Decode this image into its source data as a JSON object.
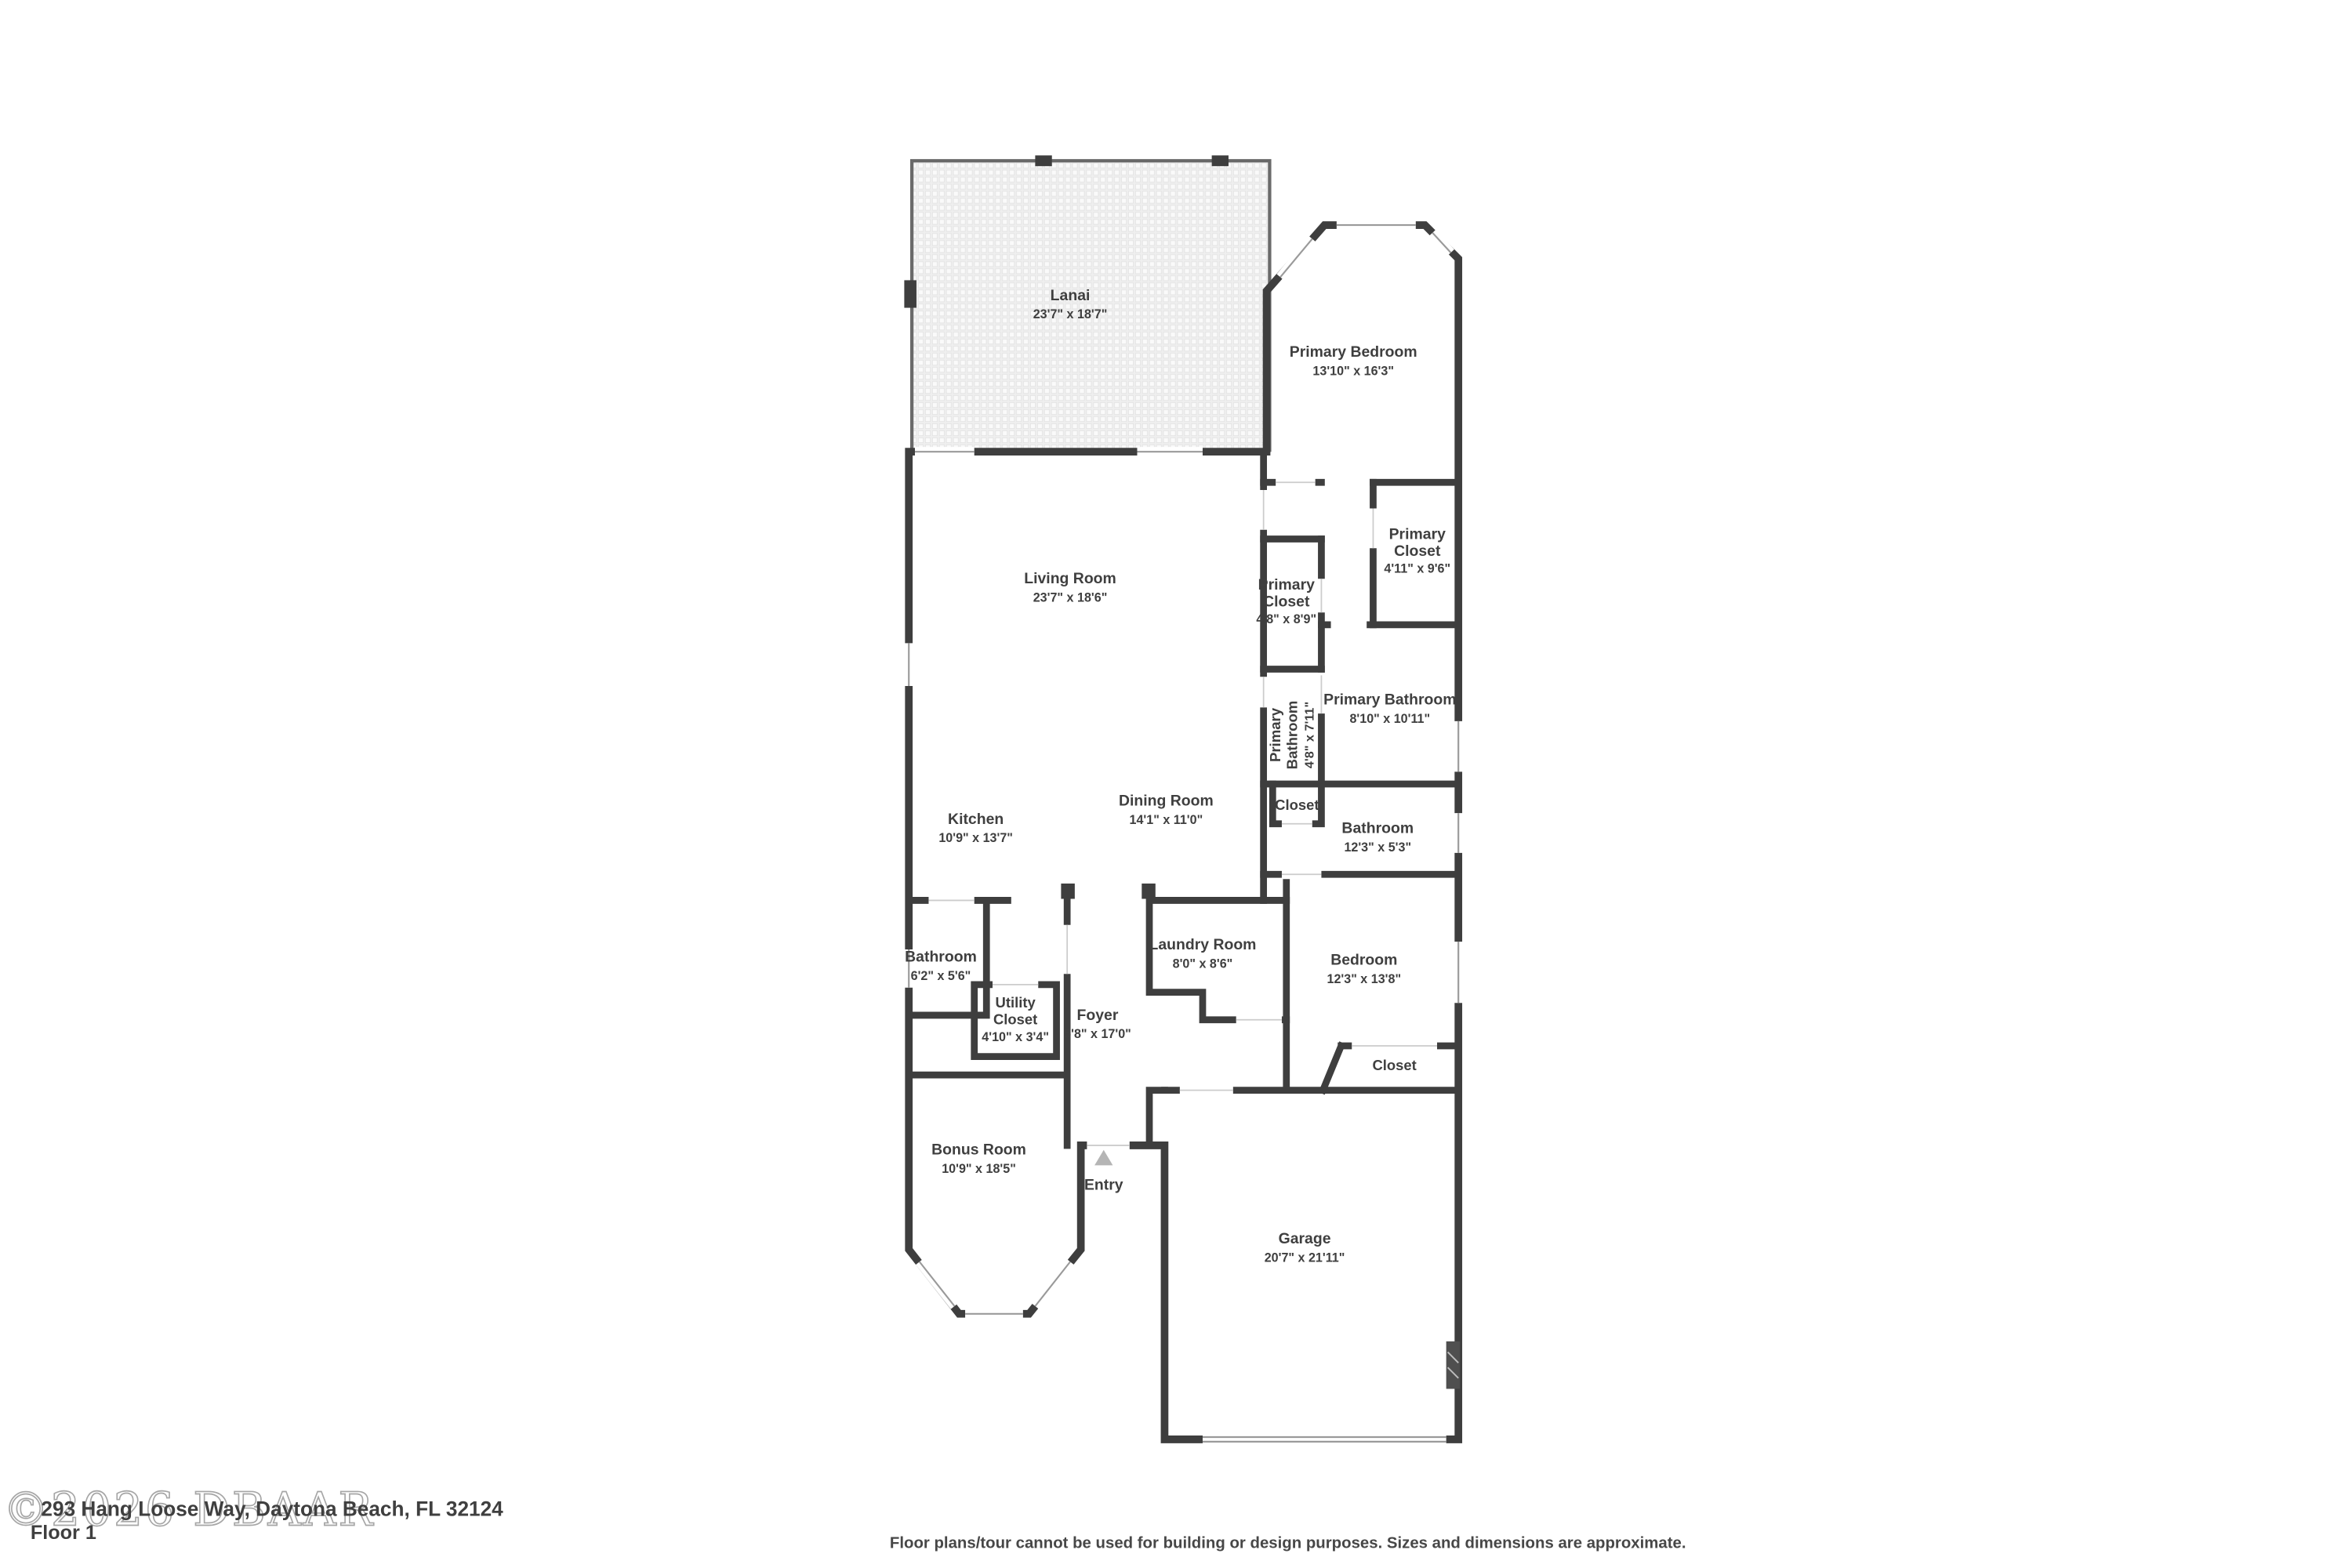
{
  "watermark": {
    "text": "©2026 DBAAR"
  },
  "footer": {
    "address": "293 Hang Loose Way, Daytona Beach, FL 32124",
    "floor_label": "Floor 1",
    "disclaimer": "Floor plans/tour cannot be used for building or design purposes. Sizes and dimensions are approximate."
  },
  "colors": {
    "wall": "#3e3e3e",
    "room_fill": "#f5f5f5",
    "label_text": "#3f3f3f",
    "entry_arrow": "#b5b5b5",
    "lanai_tile": "#efefef"
  },
  "icons": {
    "entry_arrow": "entry-direction-triangle",
    "garage_opener": "garage-wall-block"
  },
  "rooms": [
    {
      "id": "lanai",
      "lines": [
        "Lanai"
      ],
      "dims": "23'7\" x 18'7\""
    },
    {
      "id": "primary-bedroom",
      "lines": [
        "Primary Bedroom"
      ],
      "dims": "13'10\" x 16'3\""
    },
    {
      "id": "living-room",
      "lines": [
        "Living Room"
      ],
      "dims": "23'7\" x 18'6\""
    },
    {
      "id": "primary-closet-hall",
      "lines": [
        "Primary",
        "Closet"
      ],
      "dims": "4'8\" x 8'9\""
    },
    {
      "id": "primary-closet-right",
      "lines": [
        "Primary",
        "Closet"
      ],
      "dims": "4'11\" x 9'6\""
    },
    {
      "id": "primary-bathroom",
      "lines": [
        "Primary Bathroom"
      ],
      "dims": "8'10\" x 10'11\""
    },
    {
      "id": "primary-bathroom-2",
      "lines": [
        "Primary",
        "Bathroom"
      ],
      "dims": "4'8\" x 7'11\""
    },
    {
      "id": "closet-primary-hall",
      "lines": [
        "Closet"
      ],
      "dims": ""
    },
    {
      "id": "bathroom-right",
      "lines": [
        "Bathroom"
      ],
      "dims": "12'3\" x 5'3\""
    },
    {
      "id": "kitchen",
      "lines": [
        "Kitchen"
      ],
      "dims": "10'9\" x 13'7\""
    },
    {
      "id": "dining-room",
      "lines": [
        "Dining Room"
      ],
      "dims": "14'1\" x 11'0\""
    },
    {
      "id": "bathroom-left",
      "lines": [
        "Bathroom"
      ],
      "dims": "6'2\" x 5'6\""
    },
    {
      "id": "utility-closet",
      "lines": [
        "Utility",
        "Closet"
      ],
      "dims": "4'10\" x 3'4\""
    },
    {
      "id": "foyer",
      "lines": [
        "Foyer"
      ],
      "dims": "5'8\" x 17'0\""
    },
    {
      "id": "laundry-room",
      "lines": [
        "Laundry Room"
      ],
      "dims": "8'0\" x 8'6\""
    },
    {
      "id": "bedroom",
      "lines": [
        "Bedroom"
      ],
      "dims": "12'3\" x 13'8\""
    },
    {
      "id": "closet-bedroom",
      "lines": [
        "Closet"
      ],
      "dims": ""
    },
    {
      "id": "bonus-room",
      "lines": [
        "Bonus Room"
      ],
      "dims": "10'9\" x 18'5\""
    },
    {
      "id": "entry",
      "lines": [
        "Entry"
      ],
      "dims": ""
    },
    {
      "id": "garage",
      "lines": [
        "Garage"
      ],
      "dims": "20'7\" x 21'11\""
    }
  ]
}
